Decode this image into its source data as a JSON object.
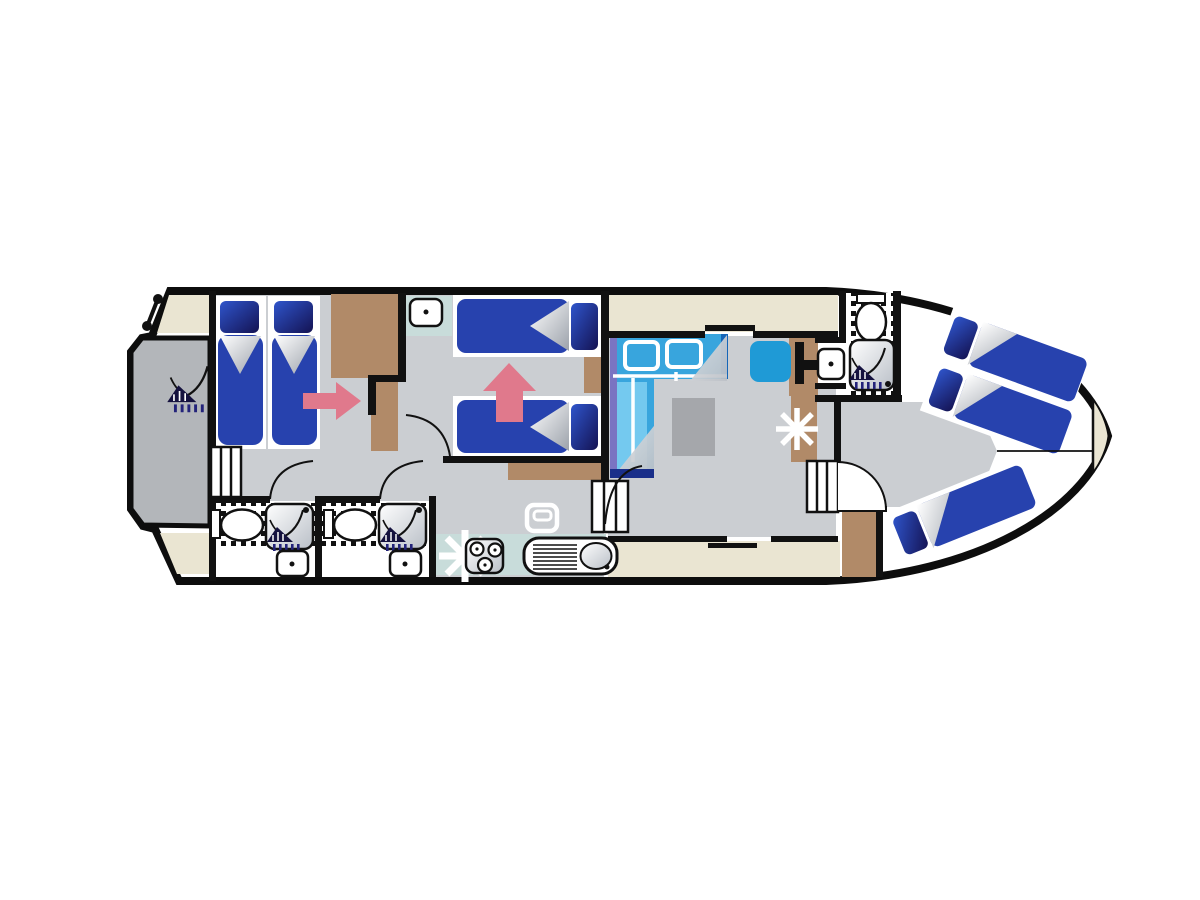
{
  "title": "houseboat-deck-plan",
  "palette": {
    "background": "#ffffff",
    "ink": "#111111",
    "hull": "#0d0d0d",
    "deck": "#eae5d2",
    "floor": "#cbced2",
    "platform": "#b3b6ba",
    "wood": "#b18a68",
    "bed_blue": "#2742ae",
    "pillow_bright": "#2f55cc",
    "pillow_dark": "#141252",
    "sofa_blue": "#38a5dd",
    "sofa_light": "#74c9ef",
    "sofa_edge_dark": "#1565b8",
    "sofa_edge_purple": "#7a74c2",
    "sofa_edge_navy": "#1a2f8a",
    "seat_blue": "#1f9ad6",
    "table_gray": "#a5a7ab",
    "counter_teal": "#c8dcda",
    "arrow_pink": "#e0798c",
    "silver_dark": "#9ba1aa",
    "symbol_navy": "#23237a",
    "white": "#ffffff"
  },
  "plan": {
    "vessel": "motor-cruiser-floor-plan",
    "rooms": [
      "stern-swim-platform",
      "aft-twin-cabin",
      "bathroom-aft-port",
      "bathroom-aft-starboard",
      "mid-twin-cabin",
      "galley",
      "salon-with-convertible-double",
      "helm-station",
      "bow-bathroom",
      "bow-cabin"
    ],
    "beds": {
      "aft_cabin_singles": 2,
      "mid_cabin_singles": 2,
      "salon_convertible_double": 1,
      "bow_cabin_singles": 3
    },
    "bathrooms": 3,
    "icons": [
      "shower-icon",
      "toilet-icon",
      "washbasin-icon",
      "stove-icon",
      "sink-drainer-icon",
      "fridge-icon",
      "table-star-icon",
      "stairs-icon",
      "flag-pole-icon",
      "direction-arrow-icon",
      "helm-wheel-icon",
      "pillow-icon"
    ]
  }
}
